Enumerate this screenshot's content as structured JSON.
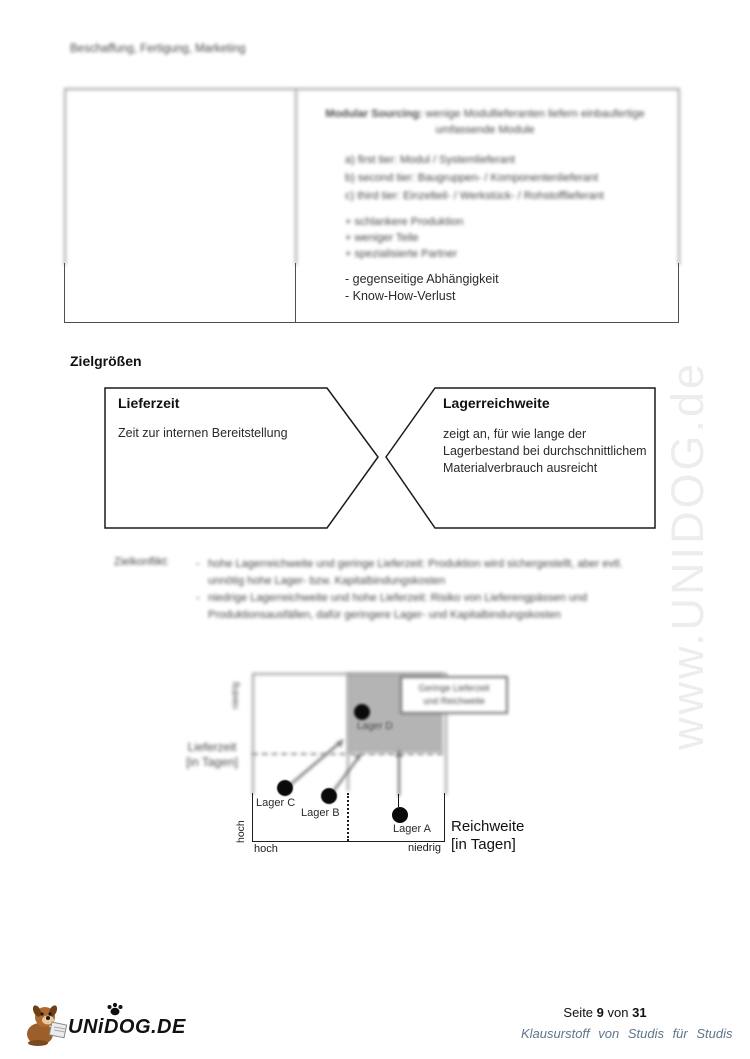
{
  "doc": {
    "header": "Beschaffung, Fertigung, Marketing"
  },
  "sourcing_table": {
    "title_bold": "Modular Sourcing:",
    "title_rest": "wenige Modullieferanten liefern einbaufertige",
    "title_line2": "umfassende Module",
    "tiers": [
      "a) first tier: Modul / Systemlieferant",
      "b) second tier: Baugruppen- / Komponentenlieferant",
      "c) third tier: Einzelteil- / Werkstück- / Rohstofflieferant"
    ],
    "pros": [
      "+ schlankere Produktion",
      "+ weniger Teile",
      "+ spezialisierte Partner"
    ],
    "cons": [
      "- gegenseitige Abhängigkeit",
      "- Know-How-Verlust"
    ]
  },
  "zielgroessen": {
    "heading": "Zielgrößen",
    "lieferzeit_title": "Lieferzeit",
    "lieferzeit_text": "Zeit zur internen Bereitstellung",
    "lagerreichweite_title": "Lagerreichweite",
    "lagerreichweite_text": "zeigt an, für wie lange der Lagerbestand bei durchschnittlichem Materialverbrauch ausreicht"
  },
  "zielkonflikt": {
    "label": "Zielkonflikt:",
    "bullet": "-",
    "items": [
      "hohe Lagerreichweite und geringe Lieferzeit: Produktion wird sichergestellt, aber evtl. unnötig hohe Lager- bzw. Kapitalbindungskosten",
      "niedrige Lagerreichweite und hohe Lieferzeit: Risiko von Lieferengpässen und Produktionsausfällen, dafür geringere Lager- und Kapitalbindungskosten"
    ]
  },
  "chart": {
    "y_axis_label_line1": "Lieferzeit",
    "y_axis_label_line2": "[in Tagen]",
    "x_axis_label_line1": "Reichweite",
    "x_axis_label_line2": "[in Tagen]",
    "y_top_label": "niedrig",
    "y_bottom_label": "hoch",
    "x_left_label": "hoch",
    "x_right_label": "niedrig",
    "callout_line1": "Geringe Lieferzeit",
    "callout_line2": "und Reichweite",
    "lager_a": "Lager A",
    "lager_b": "Lager B",
    "lager_c": "Lager C",
    "lager_d": "Lager D"
  },
  "chart_data": {
    "type": "scatter",
    "xlabel": "Reichweite [in Tagen]",
    "ylabel": "Lieferzeit [in Tagen]",
    "x_axis_ticks": [
      "hoch",
      "niedrig"
    ],
    "y_axis_ticks": [
      "hoch",
      "niedrig"
    ],
    "annotation": "Geringe Lieferzeit und Reichweite",
    "points": [
      {
        "name": "Lager A",
        "x": "niedrig",
        "y": "hoch"
      },
      {
        "name": "Lager B",
        "x": "hoch",
        "y": "hoch"
      },
      {
        "name": "Lager C",
        "x": "hoch",
        "y": "hoch"
      },
      {
        "name": "Lager D",
        "x": "niedrig",
        "y": "niedrig",
        "in_target_quadrant": true
      }
    ]
  },
  "watermark": "www.UNIDOG.de",
  "footer": {
    "seite": "Seite",
    "page_num": "9",
    "von": "von",
    "page_total": "31",
    "tagline": "Klausurstoff von Studis für Studis",
    "logo_text": "UNiDOG.DE"
  }
}
